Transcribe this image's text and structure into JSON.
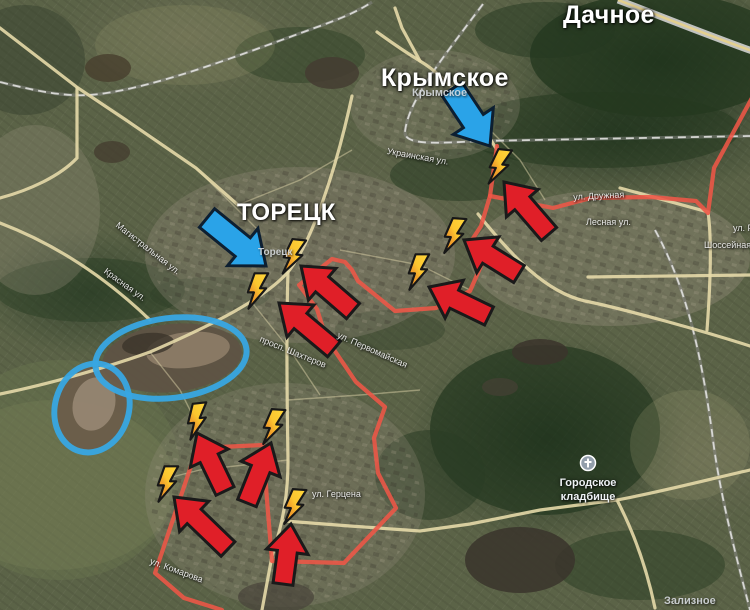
{
  "meta": {
    "width": 750,
    "height": 610,
    "title": "Toretsk frontline satellite map"
  },
  "colors": {
    "arrow_red": "#e01f28",
    "arrow_red_outline": "#1a1a1a",
    "arrow_blue": "#2aa3e8",
    "arrow_blue_outline": "#0d1f31",
    "front_line": "#ee5747",
    "ellipse_blue": "#38a7e3",
    "bolt_yellow": "#ffd83c",
    "bolt_orange": "#ec8f25",
    "bolt_outline": "#171717",
    "road": "#e6d9a8",
    "road_minor": "#d9cfa6",
    "rail": "#e9e9e6",
    "rail_casing": "#8a8a88",
    "highway_casing": "#d2d2d0",
    "highway_center": "#e3cf8f",
    "poi_icon_fill": "#929eab",
    "poi_icon_glyph": "#ffffff"
  },
  "labels": {
    "settlements": [
      {
        "text": "Дачное",
        "x": 563,
        "y": 1,
        "fs": 25
      },
      {
        "text": "Крымское",
        "x": 381,
        "y": 64,
        "fs": 25
      },
      {
        "text": "ТОРЕЦК",
        "x": 237,
        "y": 199,
        "fs": 24
      }
    ],
    "towns_minor": [
      {
        "text": "Крымское",
        "x": 412,
        "y": 87,
        "fs": 11
      },
      {
        "text": "Торецк",
        "x": 258,
        "y": 247,
        "fs": 10
      },
      {
        "text": "Зализное",
        "x": 664,
        "y": 595,
        "fs": 11
      }
    ],
    "streets": [
      {
        "text": "Украинская ул.",
        "x": 388,
        "y": 146,
        "rot": 10,
        "fs": 9
      },
      {
        "text": "Магистральная ул.",
        "x": 120,
        "y": 220,
        "rot": 38,
        "fs": 9
      },
      {
        "text": "Красная ул.",
        "x": 108,
        "y": 266,
        "rot": 36,
        "fs": 9
      },
      {
        "text": "ул. Дружная",
        "x": 573,
        "y": 192,
        "rot": -3,
        "fs": 9
      },
      {
        "text": "Лесная ул.",
        "x": 586,
        "y": 217,
        "rot": 0,
        "fs": 9
      },
      {
        "text": "ул. Ре",
        "x": 733,
        "y": 223,
        "rot": 0,
        "fs": 9
      },
      {
        "text": "Шоссейная",
        "x": 704,
        "y": 240,
        "rot": 0,
        "fs": 9
      },
      {
        "text": "просп. Шахтеров",
        "x": 262,
        "y": 334,
        "rot": 22,
        "fs": 9
      },
      {
        "text": "ул. Первомайская",
        "x": 340,
        "y": 330,
        "rot": 24,
        "fs": 9
      },
      {
        "text": "ул. Комарова",
        "x": 152,
        "y": 556,
        "rot": 20,
        "fs": 9
      },
      {
        "text": "ул. Герцена",
        "x": 312,
        "y": 489,
        "rot": 0,
        "fs": 9
      }
    ],
    "poi": {
      "line1": "Городское",
      "line2": "кладбище",
      "label_x": 588,
      "label_y": 477,
      "icon_x": 588,
      "icon_y": 463,
      "fs": 11
    }
  },
  "annotations": {
    "red_arrows": [
      {
        "x1": 549,
        "y1": 234,
        "x2": 504,
        "y2": 182
      },
      {
        "x1": 519,
        "y1": 274,
        "x2": 464,
        "y2": 240
      },
      {
        "x1": 489,
        "y1": 316,
        "x2": 429,
        "y2": 287
      },
      {
        "x1": 353,
        "y1": 311,
        "x2": 301,
        "y2": 266
      },
      {
        "x1": 334,
        "y1": 349,
        "x2": 279,
        "y2": 303
      },
      {
        "x1": 225,
        "y1": 491,
        "x2": 197,
        "y2": 433
      },
      {
        "x1": 247,
        "y1": 503,
        "x2": 271,
        "y2": 443
      },
      {
        "x1": 228,
        "y1": 549,
        "x2": 174,
        "y2": 497
      },
      {
        "x1": 283,
        "y1": 584,
        "x2": 291,
        "y2": 524
      }
    ],
    "blue_arrows": [
      {
        "x1": 452,
        "y1": 89,
        "x2": 490,
        "y2": 146
      },
      {
        "x1": 207,
        "y1": 218,
        "x2": 266,
        "y2": 266
      }
    ],
    "lightning_bolts": [
      {
        "x": 500,
        "y": 167,
        "rot": 6
      },
      {
        "x": 455,
        "y": 236,
        "rot": 4
      },
      {
        "x": 419,
        "y": 272,
        "rot": 0
      },
      {
        "x": 294,
        "y": 257,
        "rot": 6
      },
      {
        "x": 258,
        "y": 291,
        "rot": 0
      },
      {
        "x": 198,
        "y": 421,
        "rot": -6
      },
      {
        "x": 274,
        "y": 427,
        "rot": 4
      },
      {
        "x": 168,
        "y": 484,
        "rot": 0
      },
      {
        "x": 295,
        "y": 507,
        "rot": 4
      }
    ],
    "front_lines": [
      "497,146 490,196",
      "490,196 522,202 553,208 591,198 651,197 696,201 708,213 714,168 753,96",
      "490,196 481,226 470,243 484,259 470,291 436,308 395,311 358,281 352,270 345,262 332,259 299,285 317,309 326,338",
      "326,338 356,382 385,407 374,438 378,473 396,508 344,563 272,561 267,500 263,445 220,447 194,457 155,573 184,598 222,610"
    ],
    "blue_ellipses": [
      {
        "cx": 171,
        "cy": 358,
        "rx": 76,
        "ry": 40,
        "rot": -7
      },
      {
        "cx": 92,
        "cy": 408,
        "rx": 37,
        "ry": 45,
        "rot": 16
      }
    ]
  },
  "map_geometry": {
    "terrain_patches": [
      {
        "cx": 660,
        "cy": 55,
        "rx": 130,
        "ry": 62,
        "fill": "#24381f",
        "op": 0.8
      },
      {
        "cx": 600,
        "cy": 130,
        "rx": 140,
        "ry": 38,
        "fill": "#24381f",
        "op": 0.55
      },
      {
        "cx": 545,
        "cy": 30,
        "rx": 70,
        "ry": 28,
        "fill": "#24381f",
        "op": 0.5
      },
      {
        "cx": 300,
        "cy": 55,
        "rx": 65,
        "ry": 28,
        "fill": "#2a3d24",
        "op": 0.45
      },
      {
        "cx": 90,
        "cy": 290,
        "rx": 95,
        "ry": 32,
        "fill": "#2a3d24",
        "op": 0.5
      },
      {
        "cx": 210,
        "cy": 295,
        "rx": 60,
        "ry": 18,
        "fill": "#2a3d24",
        "op": 0.35
      },
      {
        "cx": 460,
        "cy": 175,
        "rx": 70,
        "ry": 26,
        "fill": "#24381f",
        "op": 0.5
      },
      {
        "cx": 545,
        "cy": 430,
        "rx": 115,
        "ry": 85,
        "fill": "#24381f",
        "op": 0.7
      },
      {
        "cx": 430,
        "cy": 475,
        "rx": 55,
        "ry": 45,
        "fill": "#2a3d24",
        "op": 0.55
      },
      {
        "cx": 640,
        "cy": 565,
        "rx": 85,
        "ry": 35,
        "fill": "#2a3d24",
        "op": 0.5
      },
      {
        "cx": 390,
        "cy": 330,
        "rx": 55,
        "ry": 20,
        "fill": "#2a3d24",
        "op": 0.35
      },
      {
        "cx": 25,
        "cy": 60,
        "rx": 60,
        "ry": 55,
        "fill": "#333f2c",
        "op": 0.45
      },
      {
        "cx": 55,
        "cy": 485,
        "rx": 120,
        "ry": 85,
        "fill": "#8a8d62",
        "op": 0.28
      },
      {
        "cx": 60,
        "cy": 470,
        "rx": 120,
        "ry": 110,
        "fill": "#6c7751",
        "op": 0.4
      },
      {
        "cx": 185,
        "cy": 45,
        "rx": 90,
        "ry": 40,
        "fill": "#99996f",
        "op": 0.2
      },
      {
        "cx": 690,
        "cy": 445,
        "rx": 60,
        "ry": 55,
        "fill": "#99996f",
        "op": 0.25
      },
      {
        "cx": 300,
        "cy": 255,
        "rx": 155,
        "ry": 88,
        "fill": "#958d7b",
        "op": 0.32
      },
      {
        "cx": 610,
        "cy": 258,
        "rx": 140,
        "ry": 68,
        "fill": "#958d7b",
        "op": 0.38
      },
      {
        "cx": 285,
        "cy": 495,
        "rx": 140,
        "ry": 112,
        "fill": "#958d7b",
        "op": 0.28
      },
      {
        "cx": 435,
        "cy": 105,
        "rx": 85,
        "ry": 55,
        "fill": "#958d7b",
        "op": 0.28
      },
      {
        "cx": 35,
        "cy": 210,
        "rx": 65,
        "ry": 85,
        "fill": "#958d7b",
        "op": 0.3
      }
    ],
    "city_pattern_zones": [
      {
        "cx": 300,
        "cy": 255,
        "rx": 150,
        "ry": 85
      },
      {
        "cx": 610,
        "cy": 258,
        "rx": 135,
        "ry": 65
      },
      {
        "cx": 285,
        "cy": 495,
        "rx": 135,
        "ry": 108
      },
      {
        "cx": 435,
        "cy": 105,
        "rx": 80,
        "ry": 52
      }
    ],
    "mounds": [
      {
        "cx": 172,
        "cy": 358,
        "rx": 70,
        "ry": 34,
        "fill": "#5e5244",
        "op": 0.92,
        "rot": -6
      },
      {
        "cx": 188,
        "cy": 350,
        "rx": 42,
        "ry": 18,
        "fill": "#a08d77",
        "op": 0.65,
        "rot": -6
      },
      {
        "cx": 148,
        "cy": 344,
        "rx": 26,
        "ry": 11,
        "fill": "#3b342b",
        "op": 0.8,
        "rot": -6
      },
      {
        "cx": 92,
        "cy": 408,
        "rx": 34,
        "ry": 42,
        "fill": "#6b5c4a",
        "op": 0.9,
        "rot": 16
      },
      {
        "cx": 94,
        "cy": 404,
        "rx": 21,
        "ry": 27,
        "fill": "#ae9c88",
        "op": 0.6,
        "rot": 16
      },
      {
        "cx": 108,
        "cy": 68,
        "rx": 23,
        "ry": 14,
        "fill": "#49412f",
        "op": 0.85,
        "rot": 0
      },
      {
        "cx": 112,
        "cy": 152,
        "rx": 18,
        "ry": 11,
        "fill": "#453d30",
        "op": 0.8,
        "rot": 0
      },
      {
        "cx": 332,
        "cy": 73,
        "rx": 27,
        "ry": 16,
        "fill": "#443c31",
        "op": 0.85,
        "rot": 0
      },
      {
        "cx": 540,
        "cy": 352,
        "rx": 28,
        "ry": 13,
        "fill": "#3b342b",
        "op": 0.85,
        "rot": 0
      },
      {
        "cx": 500,
        "cy": 387,
        "rx": 18,
        "ry": 9,
        "fill": "#464034",
        "op": 0.7,
        "rot": 0
      },
      {
        "cx": 520,
        "cy": 560,
        "rx": 55,
        "ry": 33,
        "fill": "#3a342b",
        "op": 0.85,
        "rot": 0
      },
      {
        "cx": 276,
        "cy": 597,
        "rx": 38,
        "ry": 16,
        "fill": "#49433a",
        "op": 0.7,
        "rot": 0
      }
    ],
    "roads_main": [
      "M 0,28 L 78,88 126,120 196,168 238,205",
      "M 352,96 C 336,170 312,242 288,272 C 262,302 196,332 150,352 C 100,370 40,386 0,394",
      "M 288,272 C 286,330 287,400 288,460 C 288,492 284,520 272,556 L 262,610",
      "M 285,521 L 350,526 420,531 470,524 540,510 617,500 C 660,492 706,480 750,470",
      "M 617,500 C 630,525 645,560 655,608",
      "M 478,214 C 512,256 545,292 585,301 C 620,308 700,330 750,346",
      "M 620,188 L 708,212 C 712,240 710,290 707,330",
      "M 588,277 L 750,275",
      "M 497,150 C 472,108 448,78 420,61 C 402,50 388,40 377,32",
      "M 420,61 L 402,28 395,8",
      "M 0,223 C 50,242 100,272 150,320",
      "M 77,88 L 77,158 C 60,176 30,190 0,198"
    ],
    "roads_minor": [
      "M 196,168 L 260,232",
      "M 238,205 L 300,180 352,150",
      "M 150,352 L 180,390 200,430",
      "M 288,400 L 360,395 420,390",
      "M 288,460 L 200,470 160,480",
      "M 340,250 L 420,265 470,290",
      "M 250,300 L 290,350 320,395",
      "M 480,120 L 520,160 545,200"
    ],
    "railways": [
      "M 483,4 C 445,55 408,100 405,132 C 404,146 440,143 480,141 L 750,136",
      "M 0,82 C 40,92 70,98 100,94 C 160,86 240,55 320,26 C 345,17 360,10 372,2",
      "M 655,230 C 688,290 702,360 712,432 C 719,492 736,556 750,610"
    ],
    "highway": "M 618,0 C 660,16 710,36 755,52"
  }
}
